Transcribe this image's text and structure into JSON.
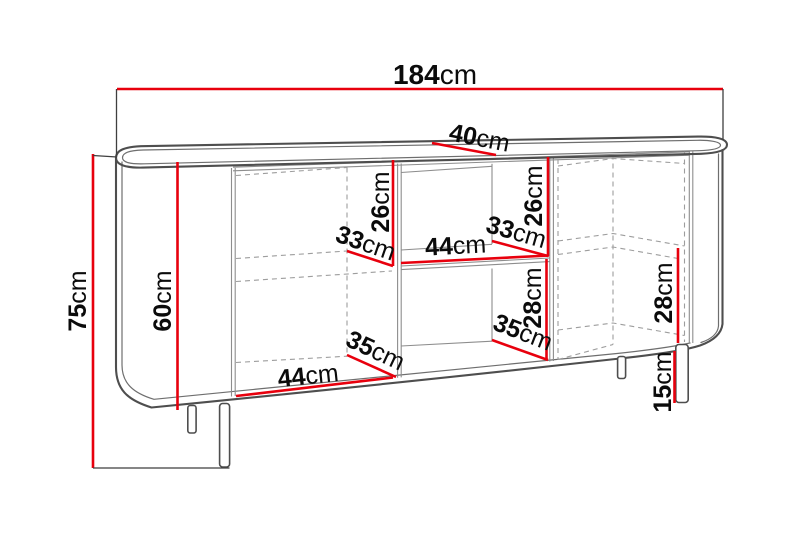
{
  "diagram": {
    "kind": "furniture-dimension-drawing",
    "item": "sideboard",
    "unit": "cm",
    "accent_color": "#e8000d",
    "line_color": "#4e4e4e"
  },
  "labels": [
    {
      "name": "overall-width",
      "num": "184",
      "unit": "cm"
    },
    {
      "name": "overall-depth",
      "num": "40",
      "unit": "cm"
    },
    {
      "name": "overall-height",
      "num": "75",
      "unit": "cm"
    },
    {
      "name": "body-height",
      "num": "60",
      "unit": "cm"
    },
    {
      "name": "left-upper-compartment-height",
      "num": "26",
      "unit": "cm"
    },
    {
      "name": "left-shelf-depth",
      "num": "33",
      "unit": "cm"
    },
    {
      "name": "middle-shelf-width",
      "num": "44",
      "unit": "cm"
    },
    {
      "name": "middle-shelf-depth",
      "num": "33",
      "unit": "cm"
    },
    {
      "name": "middle-upper-compartment-height",
      "num": "26",
      "unit": "cm"
    },
    {
      "name": "middle-lower-compartment-height",
      "num": "28",
      "unit": "cm"
    },
    {
      "name": "middle-lower-compartment-depth",
      "num": "35",
      "unit": "cm"
    },
    {
      "name": "left-lower-compartment-depth",
      "num": "35",
      "unit": "cm"
    },
    {
      "name": "left-lower-compartment-width",
      "num": "44",
      "unit": "cm"
    },
    {
      "name": "right-lower-compartment-height",
      "num": "28",
      "unit": "cm"
    },
    {
      "name": "leg-height",
      "num": "15",
      "unit": "cm"
    }
  ]
}
